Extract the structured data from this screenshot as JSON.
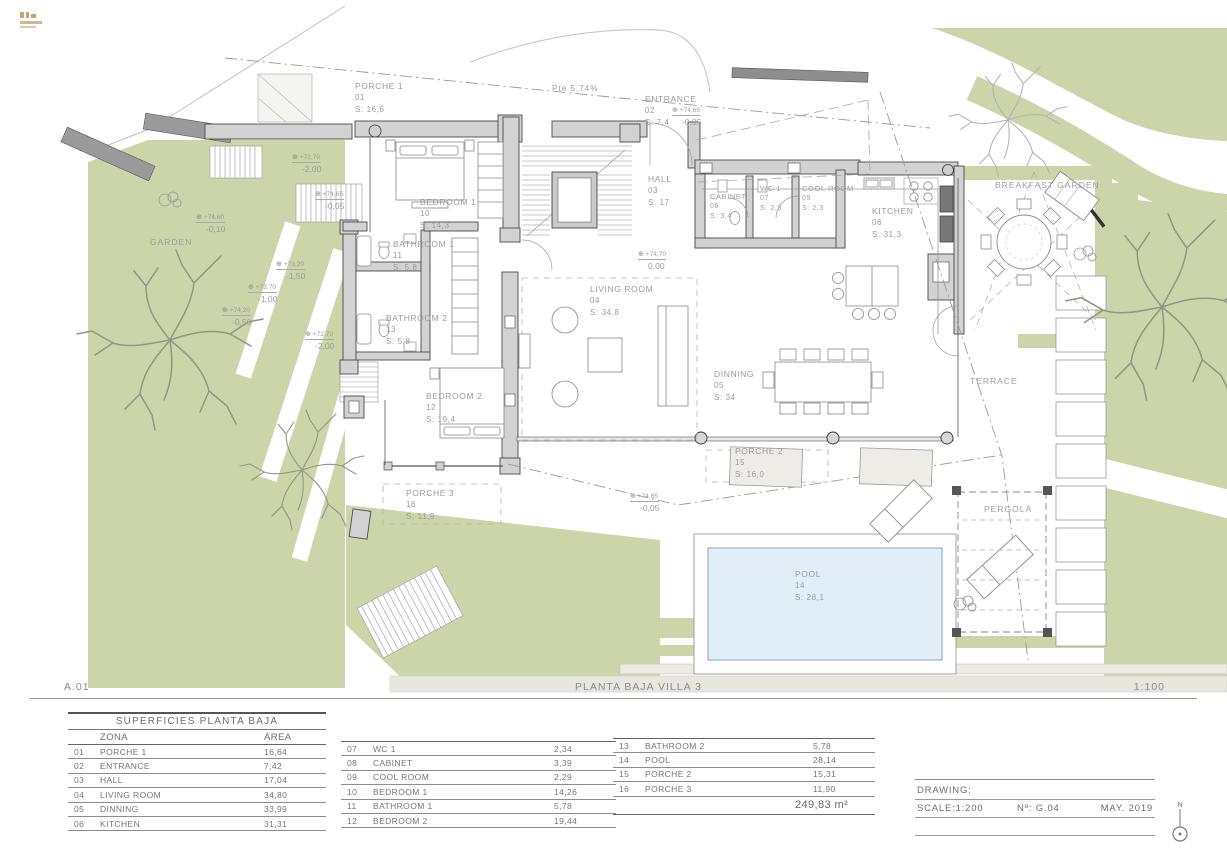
{
  "page": {
    "sheet_code": "A.01",
    "title": "PLANTA BAJA  VILLA 3",
    "scale": "1:100"
  },
  "colors": {
    "garden_green": "#cbd5a9",
    "pool_blue": "#e1edf7",
    "wall_gray": "#d2d2d2",
    "logo_tan": "#c9a273"
  },
  "plan": {
    "slope_label": "Pte  5,74%",
    "zones": [
      {
        "label": "GARDEN"
      },
      {
        "label": "TERRACE"
      },
      {
        "label": "PERGOLA"
      },
      {
        "label": "BREAKFAST GARDEN"
      }
    ],
    "rooms": [
      {
        "name": "PORCHE 1",
        "id": "01",
        "area": "S: 16,6"
      },
      {
        "name": "ENTRANCE",
        "id": "02",
        "area": "S: 7,4"
      },
      {
        "name": "HALL",
        "id": "03",
        "area": "S: 17"
      },
      {
        "name": "LIVING ROOM",
        "id": "04",
        "area": "S: 34,8"
      },
      {
        "name": "DINNING",
        "id": "05",
        "area": "S: 34"
      },
      {
        "name": "KITCHEN",
        "id": "06",
        "area": "S: 31,3"
      },
      {
        "name": "WC 1",
        "id": "07",
        "area": "S: 2,3"
      },
      {
        "name": "CABINET",
        "id": "08",
        "area": "S: 3,4"
      },
      {
        "name": "COOL ROOM",
        "id": "09",
        "area": "S: 2,3"
      },
      {
        "name": "BEDROOM 1",
        "id": "10",
        "area": "S: 14,3"
      },
      {
        "name": "BATHROOM 1",
        "id": "11",
        "area": "S: 5,8"
      },
      {
        "name": "BEDROOM 2",
        "id": "12",
        "area": "S: 19,4"
      },
      {
        "name": "BATHROOM 2",
        "id": "13",
        "area": "S: 5,8"
      },
      {
        "name": "POOL",
        "id": "14",
        "area": "S: 28,1"
      },
      {
        "name": "PORCHE 2",
        "id": "15",
        "area": "S: 16,0"
      },
      {
        "name": "PORCHE 3",
        "id": "16",
        "area": "S: 11,9"
      }
    ],
    "elevations": [
      {
        "icon": "⊕",
        "level": "+72,70",
        "value": "-2,00"
      },
      {
        "icon": "⊕",
        "level": "+74,65",
        "value": "-0,05"
      },
      {
        "icon": "⊕",
        "level": "+74,60",
        "value": "-0,10"
      },
      {
        "icon": "⊕",
        "level": "+73,20",
        "value": "-1,50"
      },
      {
        "icon": "⊕",
        "level": "+73,70",
        "value": "-1,00"
      },
      {
        "icon": "⊕",
        "level": "+74,20",
        "value": "-0,50"
      },
      {
        "icon": "⊕",
        "level": "+72,70",
        "value": "-2,00"
      },
      {
        "icon": "⊕",
        "level": "+74,70",
        "value": "0,00"
      },
      {
        "icon": "⊕",
        "level": "+74,65",
        "value": "-0,05"
      },
      {
        "icon": "⊕",
        "level": "+74,65",
        "value": "-0,05"
      }
    ]
  },
  "tables": {
    "t1": {
      "title": "SUPERFICIES PLANTA BAJA",
      "col_zone": "ZONA",
      "col_area": "ÁREA",
      "rows": [
        {
          "id": "01",
          "name": "PORCHE 1",
          "area": "16,64"
        },
        {
          "id": "02",
          "name": "ENTRANCE",
          "area": "7,42"
        },
        {
          "id": "03",
          "name": "HALL",
          "area": "17,04"
        },
        {
          "id": "04",
          "name": "LIVING ROOM",
          "area": "34,80"
        },
        {
          "id": "05",
          "name": "DINNING",
          "area": "33,99"
        },
        {
          "id": "06",
          "name": "KITCHEN",
          "area": "31,31"
        }
      ]
    },
    "t2": {
      "rows": [
        {
          "id": "07",
          "name": "WC 1",
          "area": "2,34"
        },
        {
          "id": "08",
          "name": "CABINET",
          "area": "3,39"
        },
        {
          "id": "09",
          "name": "COOL ROOM",
          "area": "2,29"
        },
        {
          "id": "10",
          "name": "BEDROOM 1",
          "area": "14,26"
        },
        {
          "id": "11",
          "name": "BATHROOM 1",
          "area": "5,78"
        },
        {
          "id": "12",
          "name": "BEDROOM 2",
          "area": "19,44"
        }
      ]
    },
    "t3": {
      "rows": [
        {
          "id": "13",
          "name": "BATHROOM 2",
          "area": "5,78"
        },
        {
          "id": "14",
          "name": "POOL",
          "area": "28,14"
        },
        {
          "id": "15",
          "name": "PORCHE 2",
          "area": "15,31"
        },
        {
          "id": "16",
          "name": "PORCHE 3",
          "area": "11,90"
        }
      ],
      "total": "249,83 m²"
    }
  },
  "titleblock": {
    "drawing_label": "DRAWING:",
    "scale": "SCALE:1:200",
    "number": "Nº: G.04",
    "date": "MAY. 2019",
    "north": "N"
  }
}
